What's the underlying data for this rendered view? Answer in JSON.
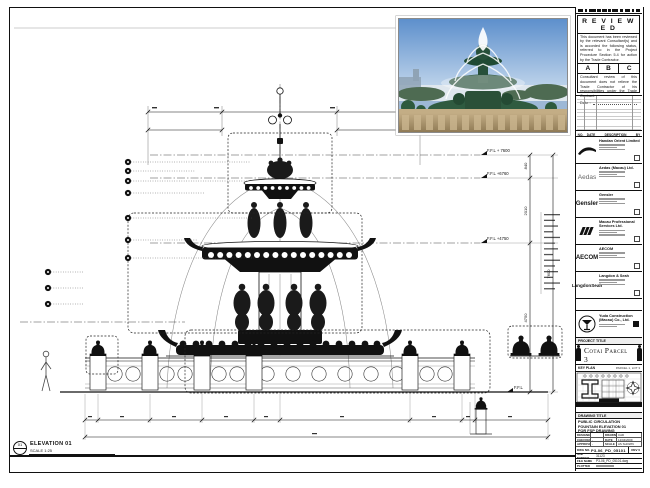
{
  "stamp": {
    "title": "R E V I E W E D",
    "body1": "This document has been reviewed by the relevant Consultant(s) and is accorded the following status, referred to in the Project Procedure Section 5.4 for action by the Trade Contractor.",
    "grades": [
      "A",
      "B",
      "C"
    ],
    "body2": "Consultant review of this document does not relieve the Trade Contractor of his responsibilities under the Trade Contract.",
    "date_label": "Date :"
  },
  "revision_table": {
    "headers": [
      "NO.",
      "DATE",
      "DESCRIPTION",
      "BY"
    ]
  },
  "consultants": [
    {
      "name": "Handan Orient Limited"
    },
    {
      "name": "Aedas (Macau) Ltd.",
      "logo_text": "Aedas"
    },
    {
      "name": "Gensler",
      "logo_text": "Gensler"
    },
    {
      "name": "Macau Professional Services Ltd."
    },
    {
      "name": "AECOM",
      "logo_text": "AECOM"
    },
    {
      "name": "Langdon & Seah",
      "logo_text": "LangdonSeah"
    }
  ],
  "contractor": {
    "name": "Yuda Construction (Macau) Co., Ltd."
  },
  "project": {
    "label": "PROJECT TITLE",
    "name": "Cotai Parcel 3"
  },
  "key_plan": {
    "label": "KEY PLAN",
    "parcel": "PARCEL 1, LOT 3"
  },
  "title_block": {
    "drawing_title_label": "DRAWING TITLE",
    "title_lines": [
      "PUBLIC CIRCULATION",
      "FOUNTAIN ELEVATION 01",
      "FOR FSP DRAWING"
    ],
    "designer_label": "DESIGNER",
    "designer": "",
    "drawn_label": "DRAWN",
    "drawn": "CAD",
    "checked_label": "CHECKED",
    "checked": "-",
    "date_label": "DATE",
    "date": "12/04/2009",
    "approved_label": "APPROVED",
    "approved": "-",
    "scale_label": "SCALE",
    "scale": "AS SHOWN",
    "dwg_no_label": "DWG NO.",
    "dwg_no": "P3-06_PD_05101",
    "rev": "REV 0",
    "job_label": "JOB NUMBER",
    "job_no": "31123",
    "file_label": "FILE NAME",
    "file_name": "P3-06_PD_05101.dwg",
    "plotted_label": "PLOTTED"
  },
  "drawing": {
    "levels": [
      "F.F.L + 7600",
      "F.F.L +6760",
      "F.F.L +4750",
      "F.F.L"
    ],
    "dim_840": "840",
    "dim_2010": "2010",
    "dim_4750": "4750",
    "dim_7600": "7600",
    "elevation_label": "ELEVATION 01",
    "scale_label": "SCALE 1:25",
    "view_no": "01"
  }
}
